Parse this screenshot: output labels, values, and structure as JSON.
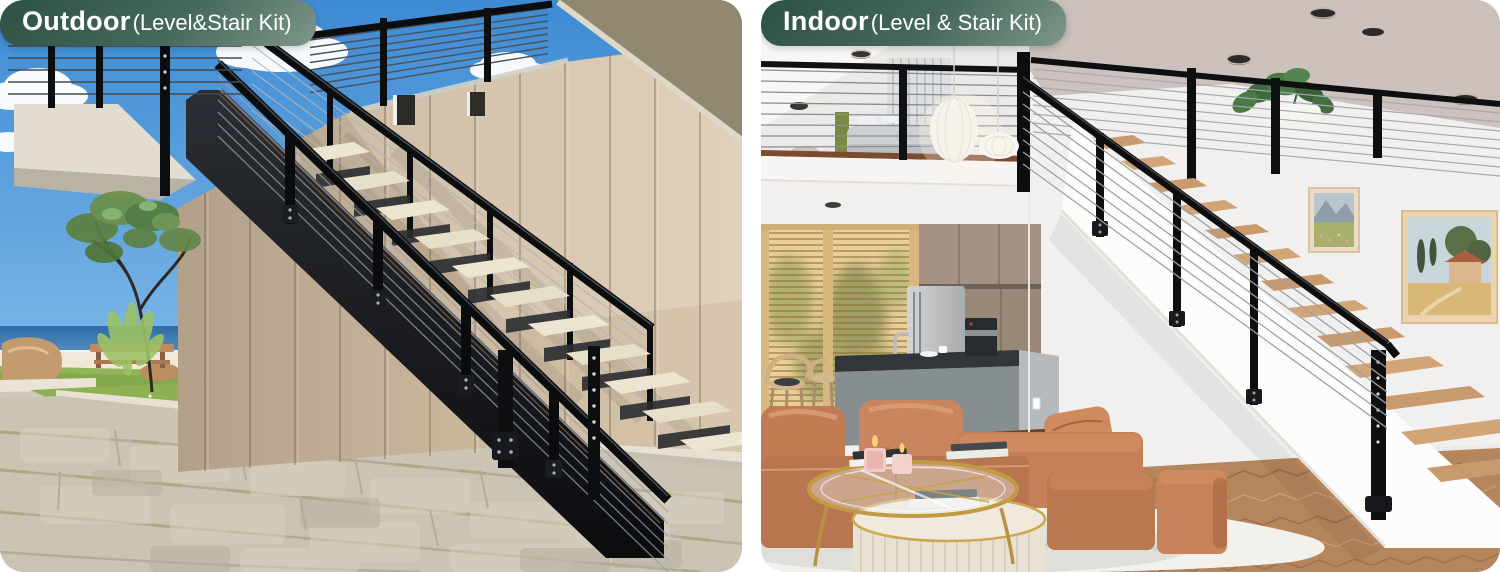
{
  "page": {
    "background": "#ffffff",
    "description": "Side-by-side product comparison photos of a black cable railing system shown outdoors and indoors"
  },
  "panels": {
    "outdoor": {
      "badge": {
        "bold": "Outdoor",
        "detail": "(Level&Stair Kit)"
      },
      "description": "Black cable railing level and stair kit on an outdoor steel staircase with wood-clad wall, beach, grass planter and cobblestone paving"
    },
    "indoor": {
      "badge": {
        "bold": "Indoor",
        "detail": "(Level & Stair Kit)"
      },
      "description": "Black cable railing level and stair kit on an indoor wood-tread staircase above a living room with leather sofa, coffee tables, kitchen and wall art"
    }
  },
  "badge_style": {
    "gradient_start": "#2d5143",
    "gradient_mid": "#45685a",
    "gradient_end": "#7e978a",
    "text_color": "#ffffff"
  },
  "palette": {
    "railing_black": "#101214",
    "outdoor_sky": "#4e97d8",
    "wood_wall": "#c4b095",
    "stair_tread_cream": "#ece5d2",
    "indoor_ceiling_greige": "#ccc1bc",
    "leather_sofa": "#c5815a",
    "stair_tread_wood": "#c79a6e",
    "gold_table": "#c39a44"
  }
}
